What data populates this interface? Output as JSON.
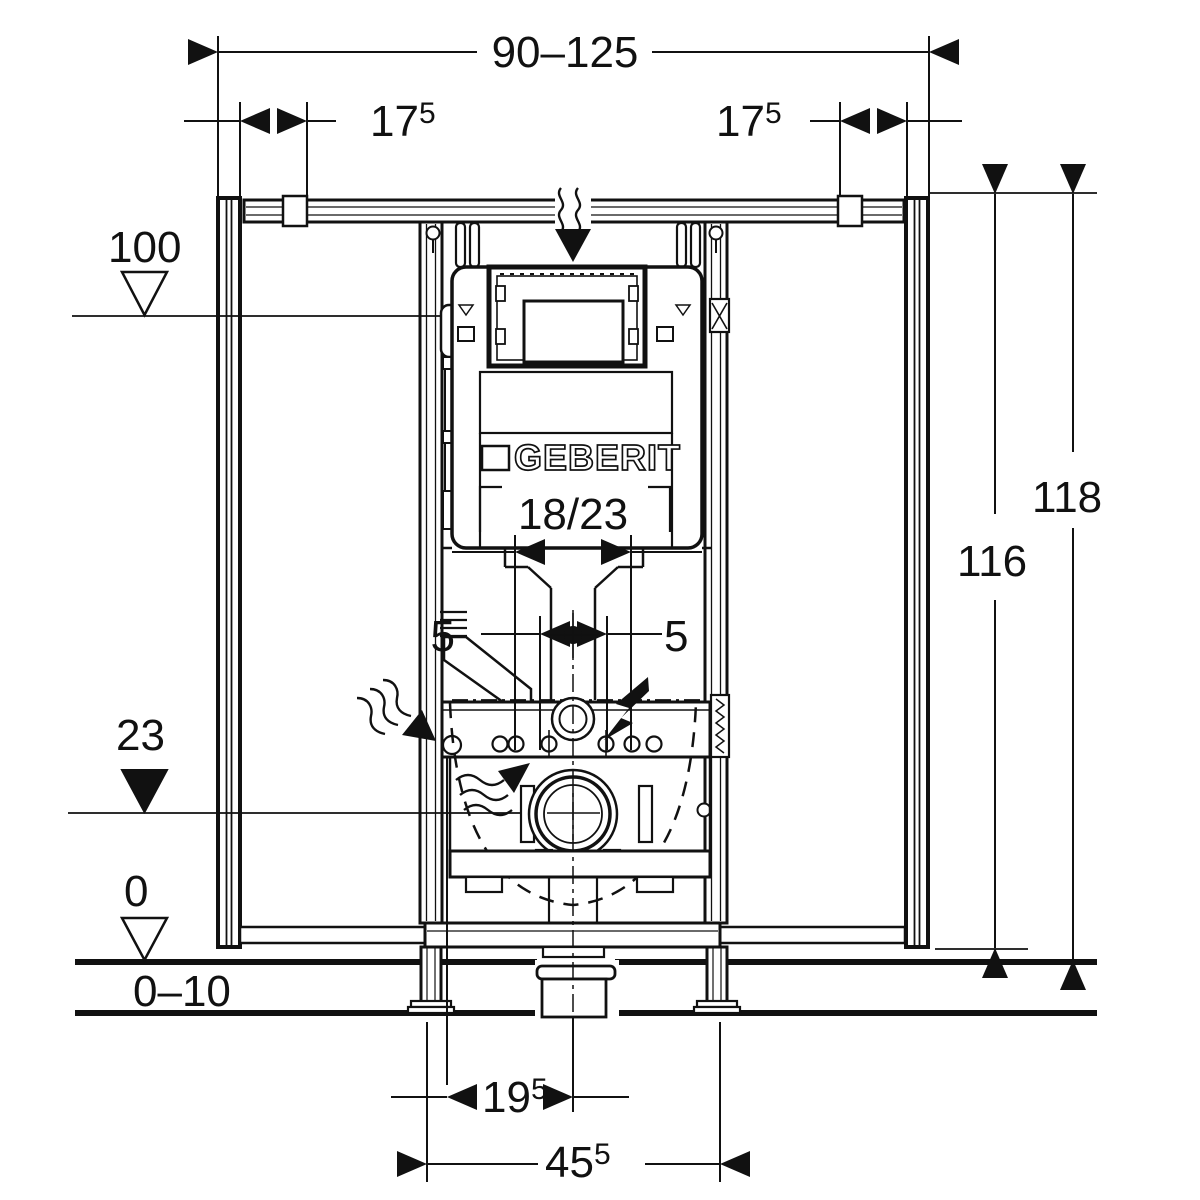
{
  "title": "Geberit installation frame dimensional drawing",
  "brand": {
    "logo_text": "GEBERIT"
  },
  "dimensions": {
    "width_range": {
      "text": "90–125"
    },
    "rail_offset_left": {
      "main": "17",
      "sup": "5"
    },
    "rail_offset_right": {
      "main": "17",
      "sup": "5"
    },
    "level_top": {
      "text": "100"
    },
    "height_outer": {
      "text": "118"
    },
    "height_frame": {
      "text": "116"
    },
    "level_drain": {
      "text": "23"
    },
    "level_floor": {
      "text": "0"
    },
    "floor_buildup": {
      "text": "0–10"
    },
    "flush_pipe": {
      "text": "18/23"
    },
    "offset_center_left": {
      "text": "5"
    },
    "offset_center_right": {
      "text": "5"
    },
    "drain_offset": {
      "main": "19",
      "sup": "5"
    },
    "drain_span": {
      "main": "45",
      "sup": "5"
    }
  },
  "colors": {
    "line": "#111111",
    "background": "#ffffff"
  }
}
